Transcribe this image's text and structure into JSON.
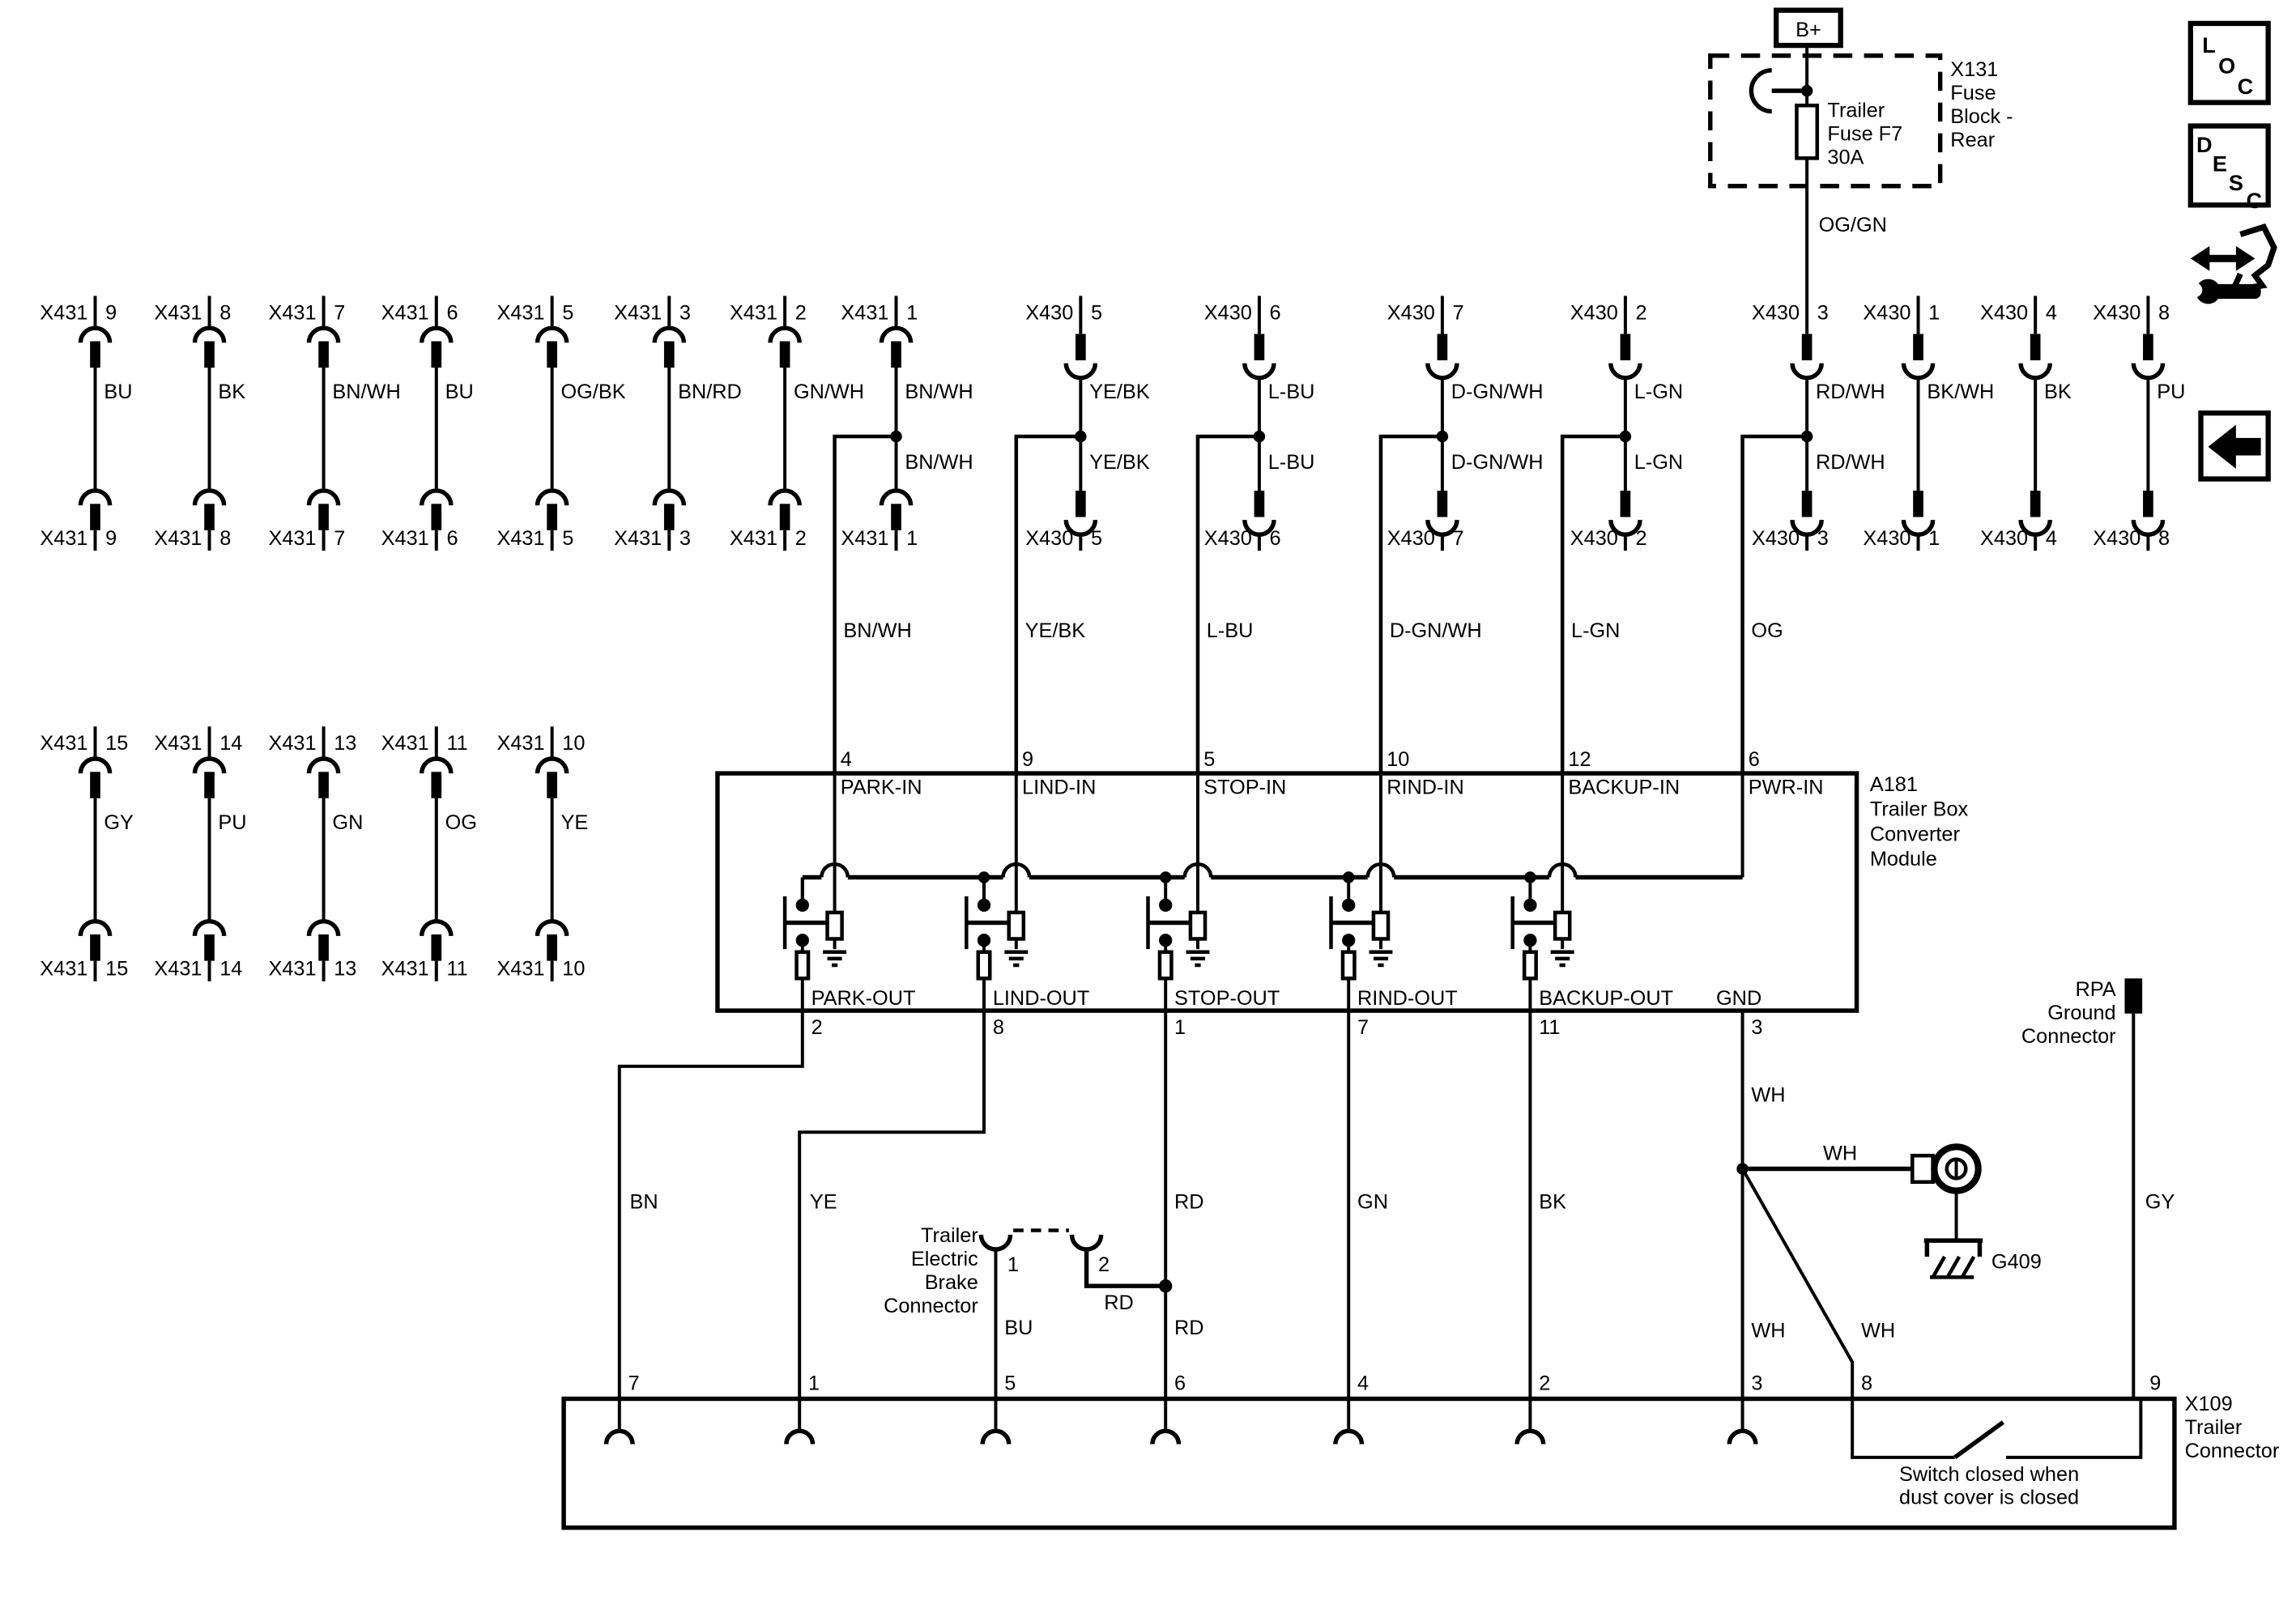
{
  "battery": {
    "label": "B+"
  },
  "fuse_block": {
    "id": "X131",
    "name_lines": [
      "Fuse",
      "Block -",
      "Rear"
    ],
    "fuse_lines": [
      "Trailer",
      "Fuse F7",
      "30A"
    ],
    "output_wire": "OG/GN"
  },
  "legend_icons": {
    "loc": [
      "L",
      "O",
      "C"
    ],
    "desc": [
      "D",
      "E",
      "S",
      "C"
    ]
  },
  "connector_groups": [
    {
      "key": "x431-top",
      "columns": [
        {
          "id": "X431",
          "pin": "9",
          "color": "BU"
        },
        {
          "id": "X431",
          "pin": "8",
          "color": "BK"
        },
        {
          "id": "X431",
          "pin": "7",
          "color": "BN/WH"
        },
        {
          "id": "X431",
          "pin": "6",
          "color": "BU"
        },
        {
          "id": "X431",
          "pin": "5",
          "color": "OG/BK"
        },
        {
          "id": "X431",
          "pin": "3",
          "color": "BN/RD"
        },
        {
          "id": "X431",
          "pin": "2",
          "color": "GN/WH"
        },
        {
          "id": "X431",
          "pin": "1",
          "color": "BN/WH",
          "color_below": "BN/WH"
        }
      ]
    },
    {
      "key": "x430-top",
      "columns": [
        {
          "id": "X430",
          "pin": "5",
          "color": "YE/BK",
          "color_below": "YE/BK"
        },
        {
          "id": "X430",
          "pin": "6",
          "color": "L-BU",
          "color_below": "L-BU"
        },
        {
          "id": "X430",
          "pin": "7",
          "color": "D-GN/WH",
          "color_below": "D-GN/WH"
        },
        {
          "id": "X430",
          "pin": "2",
          "color": "L-GN",
          "color_below": "L-GN"
        },
        {
          "id": "X430",
          "pin": "3",
          "color": "RD/WH",
          "color_below": "RD/WH"
        },
        {
          "id": "X430",
          "pin": "1",
          "color": "BK/WH"
        },
        {
          "id": "X430",
          "pin": "4",
          "color": "BK"
        },
        {
          "id": "X430",
          "pin": "8",
          "color": "PU"
        }
      ]
    },
    {
      "key": "x431-mid",
      "columns": [
        {
          "id": "X431",
          "pin": "15",
          "color": "GY"
        },
        {
          "id": "X431",
          "pin": "14",
          "color": "PU"
        },
        {
          "id": "X431",
          "pin": "13",
          "color": "GN"
        },
        {
          "id": "X431",
          "pin": "11",
          "color": "OG"
        },
        {
          "id": "X431",
          "pin": "10",
          "color": "YE"
        }
      ]
    }
  ],
  "module": {
    "id": "A181",
    "name_lines": [
      "Trailer Box",
      "Converter",
      "Module"
    ],
    "inputs": [
      {
        "pin": "4",
        "label": "PARK-IN",
        "wire": "BN/WH"
      },
      {
        "pin": "9",
        "label": "LIND-IN",
        "wire": "YE/BK"
      },
      {
        "pin": "5",
        "label": "STOP-IN",
        "wire": "L-BU"
      },
      {
        "pin": "10",
        "label": "RIND-IN",
        "wire": "D-GN/WH"
      },
      {
        "pin": "12",
        "label": "BACKUP-IN",
        "wire": "L-GN"
      },
      {
        "pin": "6",
        "label": "PWR-IN",
        "wire": "OG"
      }
    ],
    "outputs": [
      {
        "pin": "2",
        "label": "PARK-OUT",
        "wire": "BN"
      },
      {
        "pin": "8",
        "label": "LIND-OUT",
        "wire": "YE"
      },
      {
        "pin": "1",
        "label": "STOP-OUT",
        "wire": "RD"
      },
      {
        "pin": "7",
        "label": "RIND-OUT",
        "wire": "GN"
      },
      {
        "pin": "11",
        "label": "BACKUP-OUT",
        "wire": "BK"
      },
      {
        "pin": "3",
        "label": "GND",
        "wire": "WH"
      }
    ]
  },
  "brake_connector": {
    "name_lines": [
      "Trailer",
      "Electric",
      "Brake",
      "Connector"
    ],
    "pins": [
      "1",
      "2"
    ],
    "wires": [
      "BU",
      "RD"
    ]
  },
  "grounds": {
    "g409": "G409",
    "rpa_lines": [
      "RPA",
      "Ground",
      "Connector"
    ],
    "rpa_wire": "GY"
  },
  "x109": {
    "id_lines": [
      "X109",
      "Trailer",
      "Connector"
    ],
    "pins": [
      "7",
      "1",
      "5",
      "6",
      "4",
      "2",
      "3",
      "8",
      "9"
    ],
    "switch_note": [
      "Switch closed when",
      "dust cover is closed"
    ]
  }
}
